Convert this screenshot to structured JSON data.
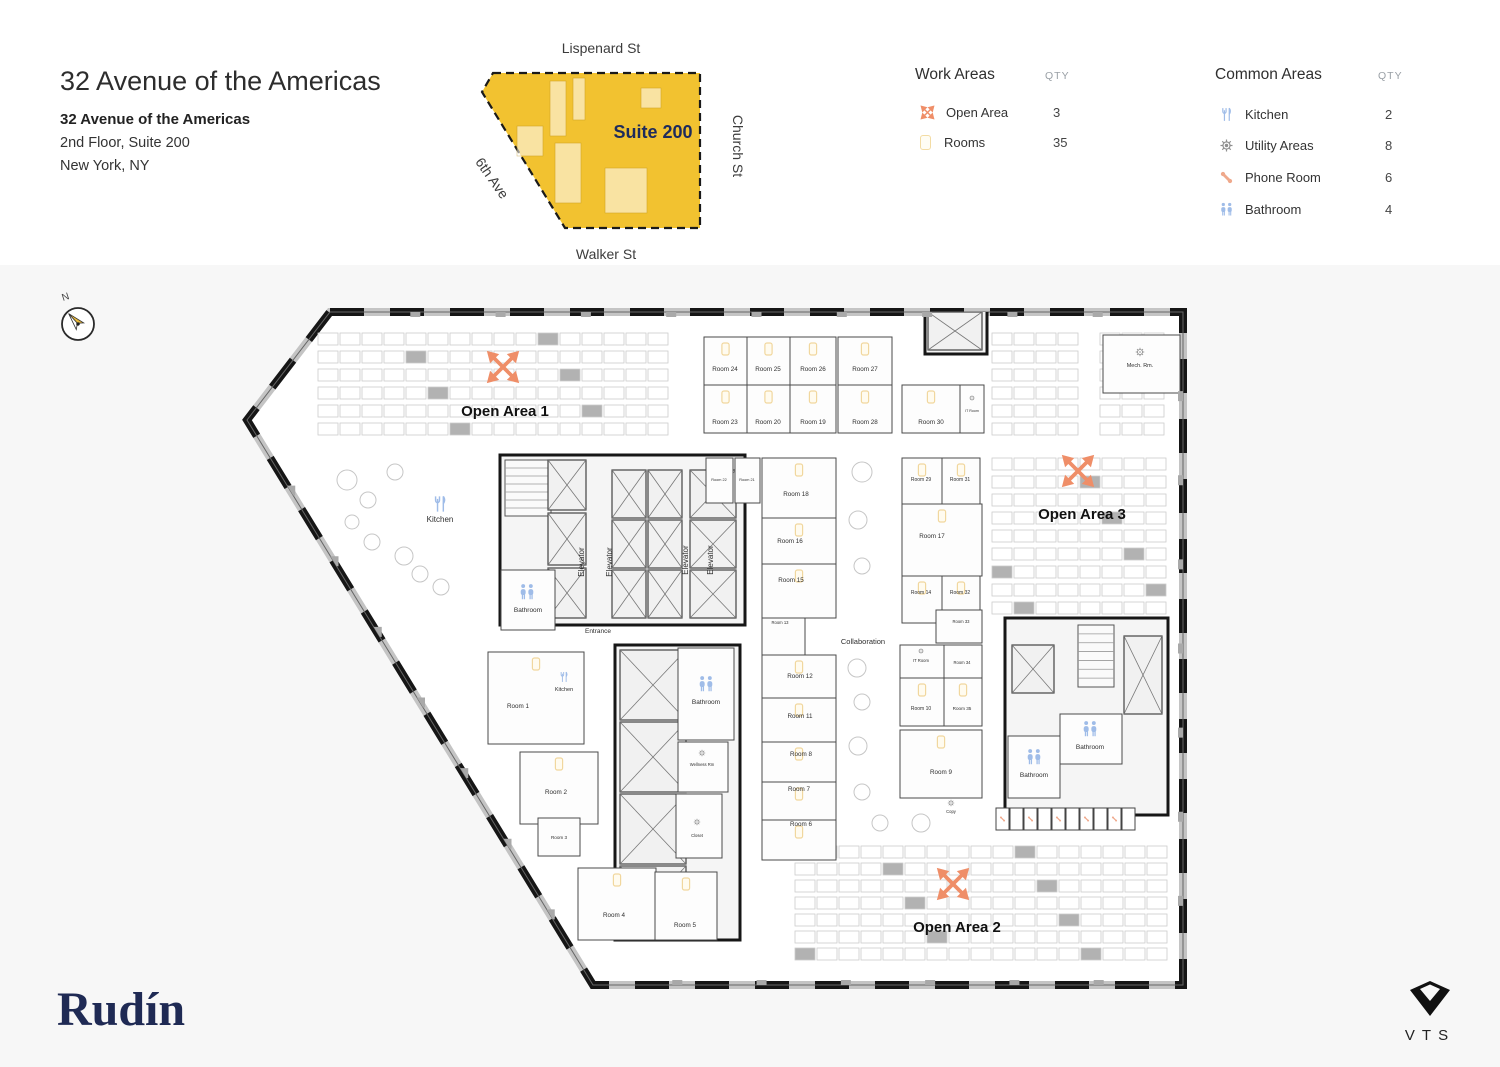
{
  "header": {
    "title": "32 Avenue of the Americas",
    "building": "32 Avenue of the Americas",
    "floor_suite": "2nd Floor, Suite 200",
    "city": "New York, NY"
  },
  "minimap": {
    "street_top": "Lispenard St",
    "street_bottom": "Walker St",
    "street_right": "Church St",
    "street_left": "6th Ave",
    "suite_label": "Suite 200",
    "suite_fill": "#F2C230",
    "suite_text_color": "#1E2B5C"
  },
  "legend_work": {
    "title": "Work Areas",
    "qty_header": "QTY",
    "items": [
      {
        "icon": "open-area-icon",
        "label": "Open Area",
        "qty": "3"
      },
      {
        "icon": "rooms-icon",
        "label": "Rooms",
        "qty": "35"
      }
    ]
  },
  "legend_common": {
    "title": "Common Areas",
    "qty_header": "QTY",
    "items": [
      {
        "icon": "kitchen-icon",
        "label": "Kitchen",
        "qty": "2"
      },
      {
        "icon": "utility-icon",
        "label": "Utility Areas",
        "qty": "8"
      },
      {
        "icon": "phone-icon",
        "label": "Phone Room",
        "qty": "6"
      },
      {
        "icon": "bathroom-icon",
        "label": "Bathroom",
        "qty": "4"
      }
    ]
  },
  "compass": {
    "label": "N"
  },
  "footer": {
    "brand": "Rudín",
    "partner": "VTS"
  },
  "floorplan": {
    "colors": {
      "orange": "#EF8E68",
      "blue": "#9FBCE8",
      "salmon": "#EFA98C",
      "gear": "#8f8f8f",
      "marker": "#F1D79E",
      "wall": "#161616"
    },
    "outline": [
      [
        330,
        312
      ],
      [
        1183,
        312
      ],
      [
        1183,
        985
      ],
      [
        593,
        985
      ],
      [
        247,
        420
      ]
    ],
    "desk_grids": [
      [
        318,
        333,
        16,
        6,
        20,
        12,
        22,
        18
      ],
      [
        992,
        333,
        4,
        6,
        20,
        12,
        22,
        18
      ],
      [
        1100,
        333,
        3,
        6,
        20,
        12,
        22,
        18
      ],
      [
        992,
        458,
        8,
        9,
        20,
        12,
        22,
        18
      ],
      [
        795,
        846,
        17,
        7,
        20,
        12,
        22,
        17
      ]
    ],
    "circles": [
      [
        347,
        480,
        10
      ],
      [
        368,
        500,
        8
      ],
      [
        395,
        472,
        8
      ],
      [
        404,
        556,
        9
      ],
      [
        420,
        574,
        8
      ],
      [
        372,
        542,
        8
      ],
      [
        441,
        587,
        8
      ],
      [
        352,
        522,
        7
      ],
      [
        862,
        472,
        10
      ],
      [
        858,
        520,
        9
      ],
      [
        862,
        566,
        8
      ],
      [
        857,
        668,
        9
      ],
      [
        862,
        702,
        8
      ],
      [
        858,
        746,
        9
      ],
      [
        862,
        792,
        8
      ],
      [
        921,
        823,
        9
      ],
      [
        880,
        823,
        8
      ]
    ],
    "cores": [
      [
        500,
        455,
        245,
        170
      ],
      [
        615,
        645,
        125,
        295
      ],
      [
        1005,
        618,
        163,
        197
      ],
      [
        925,
        310,
        62,
        44
      ]
    ],
    "stairs": [
      [
        505,
        460,
        46,
        56,
        7
      ],
      [
        1078,
        625,
        36,
        62,
        7
      ]
    ],
    "shafts": [
      [
        548,
        460,
        38,
        50
      ],
      [
        548,
        513,
        38,
        52
      ],
      [
        548,
        568,
        38,
        50
      ],
      [
        612,
        470,
        34,
        48
      ],
      [
        648,
        470,
        34,
        48
      ],
      [
        612,
        520,
        34,
        48
      ],
      [
        648,
        520,
        34,
        48
      ],
      [
        612,
        570,
        34,
        48
      ],
      [
        648,
        570,
        34,
        48
      ],
      [
        690,
        470,
        46,
        48
      ],
      [
        690,
        520,
        46,
        48
      ],
      [
        690,
        570,
        46,
        48
      ],
      [
        620,
        650,
        66,
        70
      ],
      [
        620,
        722,
        66,
        70
      ],
      [
        620,
        794,
        66,
        70
      ],
      [
        620,
        866,
        66,
        70
      ],
      [
        928,
        312,
        54,
        38
      ],
      [
        1012,
        645,
        42,
        48
      ],
      [
        1124,
        636,
        38,
        78
      ]
    ],
    "booths": {
      "x": 996,
      "y": 808,
      "n": 10,
      "w": 13,
      "h": 22
    },
    "rooms": [
      [
        "Room 24",
        704,
        337,
        43,
        48,
        725,
        371
      ],
      [
        "Room 25",
        747,
        337,
        43,
        48,
        768,
        371
      ],
      [
        "Room 26",
        790,
        337,
        46,
        48,
        813,
        371
      ],
      [
        "Room 23",
        704,
        385,
        43,
        48,
        725,
        424
      ],
      [
        "Room 20",
        747,
        385,
        43,
        48,
        768,
        424
      ],
      [
        "Room 19",
        790,
        385,
        46,
        48,
        813,
        424
      ],
      [
        "Room 27",
        838,
        337,
        54,
        48,
        865,
        371
      ],
      [
        "Room 28",
        838,
        385,
        54,
        48,
        865,
        424
      ],
      [
        "Room 30",
        902,
        385,
        58,
        48,
        931,
        424
      ],
      [
        "IT Room",
        960,
        385,
        24,
        48,
        972,
        412,
        3.6,
        0
      ],
      [
        "Room 22",
        706,
        458,
        27,
        45,
        719,
        481,
        3.8,
        0
      ],
      [
        "Room 21",
        735,
        458,
        25,
        45,
        747,
        481,
        3.8,
        0
      ],
      [
        "Room 18",
        762,
        458,
        74,
        60,
        796,
        496
      ],
      [
        "Room 16",
        762,
        518,
        74,
        46,
        790,
        543
      ],
      [
        "Room 15",
        762,
        564,
        74,
        54,
        791,
        582
      ],
      [
        "Room 13",
        762,
        618,
        43,
        37,
        780,
        624,
        4.2,
        0
      ],
      [
        "Room 12",
        762,
        655,
        74,
        43,
        800,
        678
      ],
      [
        "Room 11",
        762,
        698,
        74,
        44,
        800,
        718
      ],
      [
        "Room 8",
        762,
        742,
        74,
        40,
        801,
        756
      ],
      [
        "Room 7",
        762,
        782,
        74,
        38,
        799,
        791
      ],
      [
        "Room 6",
        762,
        820,
        74,
        40,
        801,
        826
      ],
      [
        "Room 29",
        902,
        458,
        40,
        46,
        921,
        481,
        5,
        1
      ],
      [
        "Room 31",
        942,
        458,
        38,
        46,
        960,
        481,
        5,
        1
      ],
      [
        "Room 17",
        902,
        504,
        80,
        72,
        932,
        538
      ],
      [
        "Room 14",
        902,
        576,
        40,
        47,
        921,
        594,
        5,
        1
      ],
      [
        "Room 32",
        942,
        576,
        38,
        47,
        960,
        594,
        5,
        1
      ],
      [
        "Room 33",
        936,
        610,
        46,
        33,
        961,
        623,
        4.2,
        0
      ],
      [
        "IT Room",
        900,
        645,
        44,
        33,
        921,
        662,
        4.2,
        0
      ],
      [
        "Room 34",
        944,
        645,
        38,
        33,
        962,
        664,
        4.2,
        0
      ],
      [
        "Room 10",
        900,
        678,
        44,
        48,
        921,
        710,
        5,
        1
      ],
      [
        "Room 35",
        944,
        678,
        38,
        48,
        962,
        710,
        4.6,
        1
      ],
      [
        "Room 9",
        900,
        730,
        82,
        68,
        941,
        774
      ],
      [
        "Room 1",
        488,
        652,
        96,
        92,
        518,
        708
      ],
      [
        "Room 2",
        520,
        752,
        78,
        72,
        556,
        794
      ],
      [
        "Room 3",
        538,
        818,
        42,
        38,
        559,
        839,
        4.6,
        0
      ],
      [
        "Room 4",
        578,
        868,
        78,
        72,
        614,
        917
      ],
      [
        "Room 5",
        655,
        872,
        62,
        68,
        685,
        927
      ],
      [
        "Mech. Rm.",
        1103,
        335,
        77,
        58,
        1140,
        367,
        5.5,
        0
      ],
      [
        "Wellness Rm",
        678,
        742,
        50,
        50,
        702,
        766,
        4.2,
        0
      ],
      [
        "Closet",
        676,
        794,
        46,
        64,
        697,
        837,
        4.2,
        0
      ],
      [
        "Bathroom",
        501,
        570,
        54,
        60,
        528,
        612,
        6.5,
        0
      ],
      [
        "Bathroom",
        678,
        648,
        56,
        92,
        706,
        704,
        6.5,
        0
      ],
      [
        "Bathroom",
        1008,
        736,
        52,
        62,
        1034,
        777,
        6.5,
        0
      ],
      [
        "Bathroom",
        1060,
        714,
        62,
        50,
        1090,
        749,
        6.5,
        0
      ]
    ],
    "labels": [
      [
        "Open Area 1",
        505,
        416,
        15,
        700
      ],
      [
        "Open Area 3",
        1082,
        519,
        15,
        700
      ],
      [
        "Open Area 2",
        957,
        932,
        15,
        700
      ],
      [
        "Collaboration",
        863,
        644,
        7.5
      ],
      [
        "Entrance",
        598,
        633,
        6.5
      ],
      [
        "Kitchen",
        440,
        522,
        8
      ],
      [
        "Kitchen",
        564,
        691,
        5.5
      ],
      [
        "Elevator",
        584,
        562,
        8,
        400,
        -90
      ],
      [
        "Elevator",
        612,
        562,
        8,
        400,
        -90
      ],
      [
        "Elevator",
        688,
        560,
        8,
        400,
        -90
      ],
      [
        "Elevator",
        713,
        560,
        8,
        400,
        -90
      ],
      [
        "Copy",
        951,
        813,
        4.2
      ]
    ],
    "icons": [
      [
        "move",
        503,
        367,
        1.9
      ],
      [
        "move",
        1078,
        471,
        1.9
      ],
      [
        "move",
        953,
        884,
        1.9
      ],
      [
        "kitchen",
        440,
        504,
        0.85
      ],
      [
        "kitchen",
        564,
        677,
        0.55
      ],
      [
        "bath",
        527,
        592,
        0.85
      ],
      [
        "bath",
        706,
        684,
        0.85
      ],
      [
        "bath",
        1034,
        757,
        0.85
      ],
      [
        "bath",
        1090,
        729,
        0.85
      ],
      [
        "gear",
        1140,
        352,
        0.5
      ],
      [
        "gear",
        702,
        753,
        0.38
      ],
      [
        "gear",
        697,
        822,
        0.38
      ],
      [
        "gear",
        951,
        803,
        0.38
      ],
      [
        "gear",
        921,
        651,
        0.33
      ],
      [
        "gear",
        972,
        398,
        0.33
      ]
    ]
  }
}
